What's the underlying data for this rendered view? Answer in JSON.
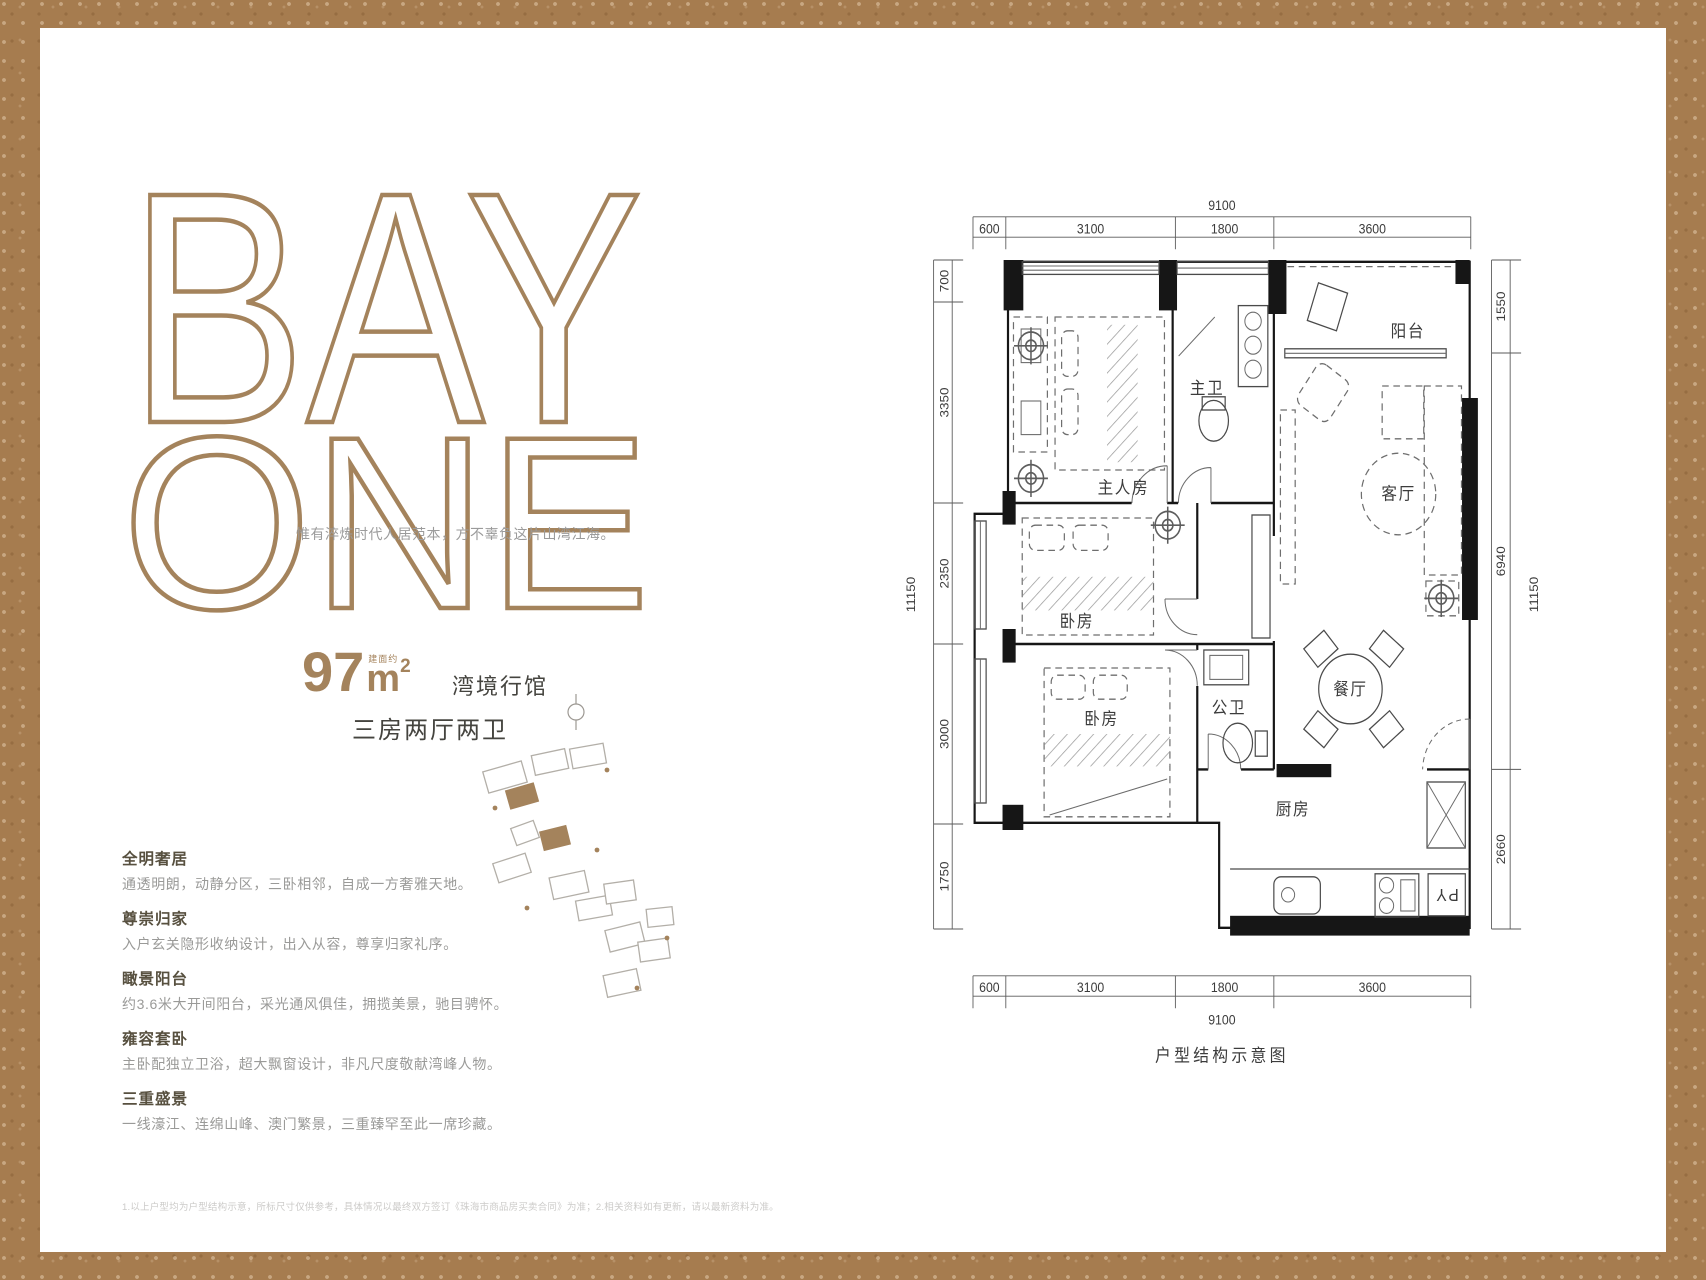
{
  "brand": {
    "line1": "BAY",
    "line2": "ONE",
    "tagline": "惟有淬炼时代人居范本，方不辜负这片山湾江海。"
  },
  "unit": {
    "area_prefix": "建面约",
    "area_number": "97",
    "area_unit": "m",
    "area_sup": "2",
    "series_name": "湾境行馆",
    "layout": "三房两厅两卫"
  },
  "features": [
    {
      "title": "全明奢居",
      "desc": "通透明朗，动静分区，三卧相邻，自成一方奢雅天地。"
    },
    {
      "title": "尊崇归家",
      "desc": "入户玄关隐形收纳设计，出入从容，尊享归家礼序。"
    },
    {
      "title": "瞰景阳台",
      "desc": "约3.6米大开间阳台，采光通风俱佳，拥揽美景，驰目骋怀。"
    },
    {
      "title": "雍容套卧",
      "desc": "主卧配独立卫浴，超大飘窗设计，非凡尺度敬献湾峰人物。"
    },
    {
      "title": "三重盛景",
      "desc": "一线濠江、连绵山峰、澳门繁景，三重臻罕至此一席珍藏。"
    }
  ],
  "floorplan": {
    "caption": "户型结构示意图",
    "rooms": {
      "master": "主人房",
      "bedroom1": "卧房",
      "bedroom2": "卧房",
      "master_bath": "主卫",
      "bath": "公卫",
      "living": "客厅",
      "dining": "餐厅",
      "kitchen": "厨房",
      "balcony": "阳台",
      "fridge": "PY"
    },
    "dims": {
      "top_total": "9100",
      "top_segments": [
        "600",
        "3100",
        "1800",
        "3600"
      ],
      "bottom_segments": [
        "600",
        "3100",
        "1800",
        "3600"
      ],
      "bottom_total": "9100",
      "left_total": "11150",
      "left_segments": [
        "700",
        "3350",
        "2350",
        "3000",
        "1750"
      ],
      "right_total": "11150",
      "right_segments": [
        "1550",
        "6940",
        "2660"
      ]
    }
  },
  "disclaimer": "1.以上户型均为户型结构示意，所标尺寸仅供参考，具体情况以最终双方签订《珠海市商品房买卖合同》为准；2.相关资料如有更新，请以最新资料为准。"
}
